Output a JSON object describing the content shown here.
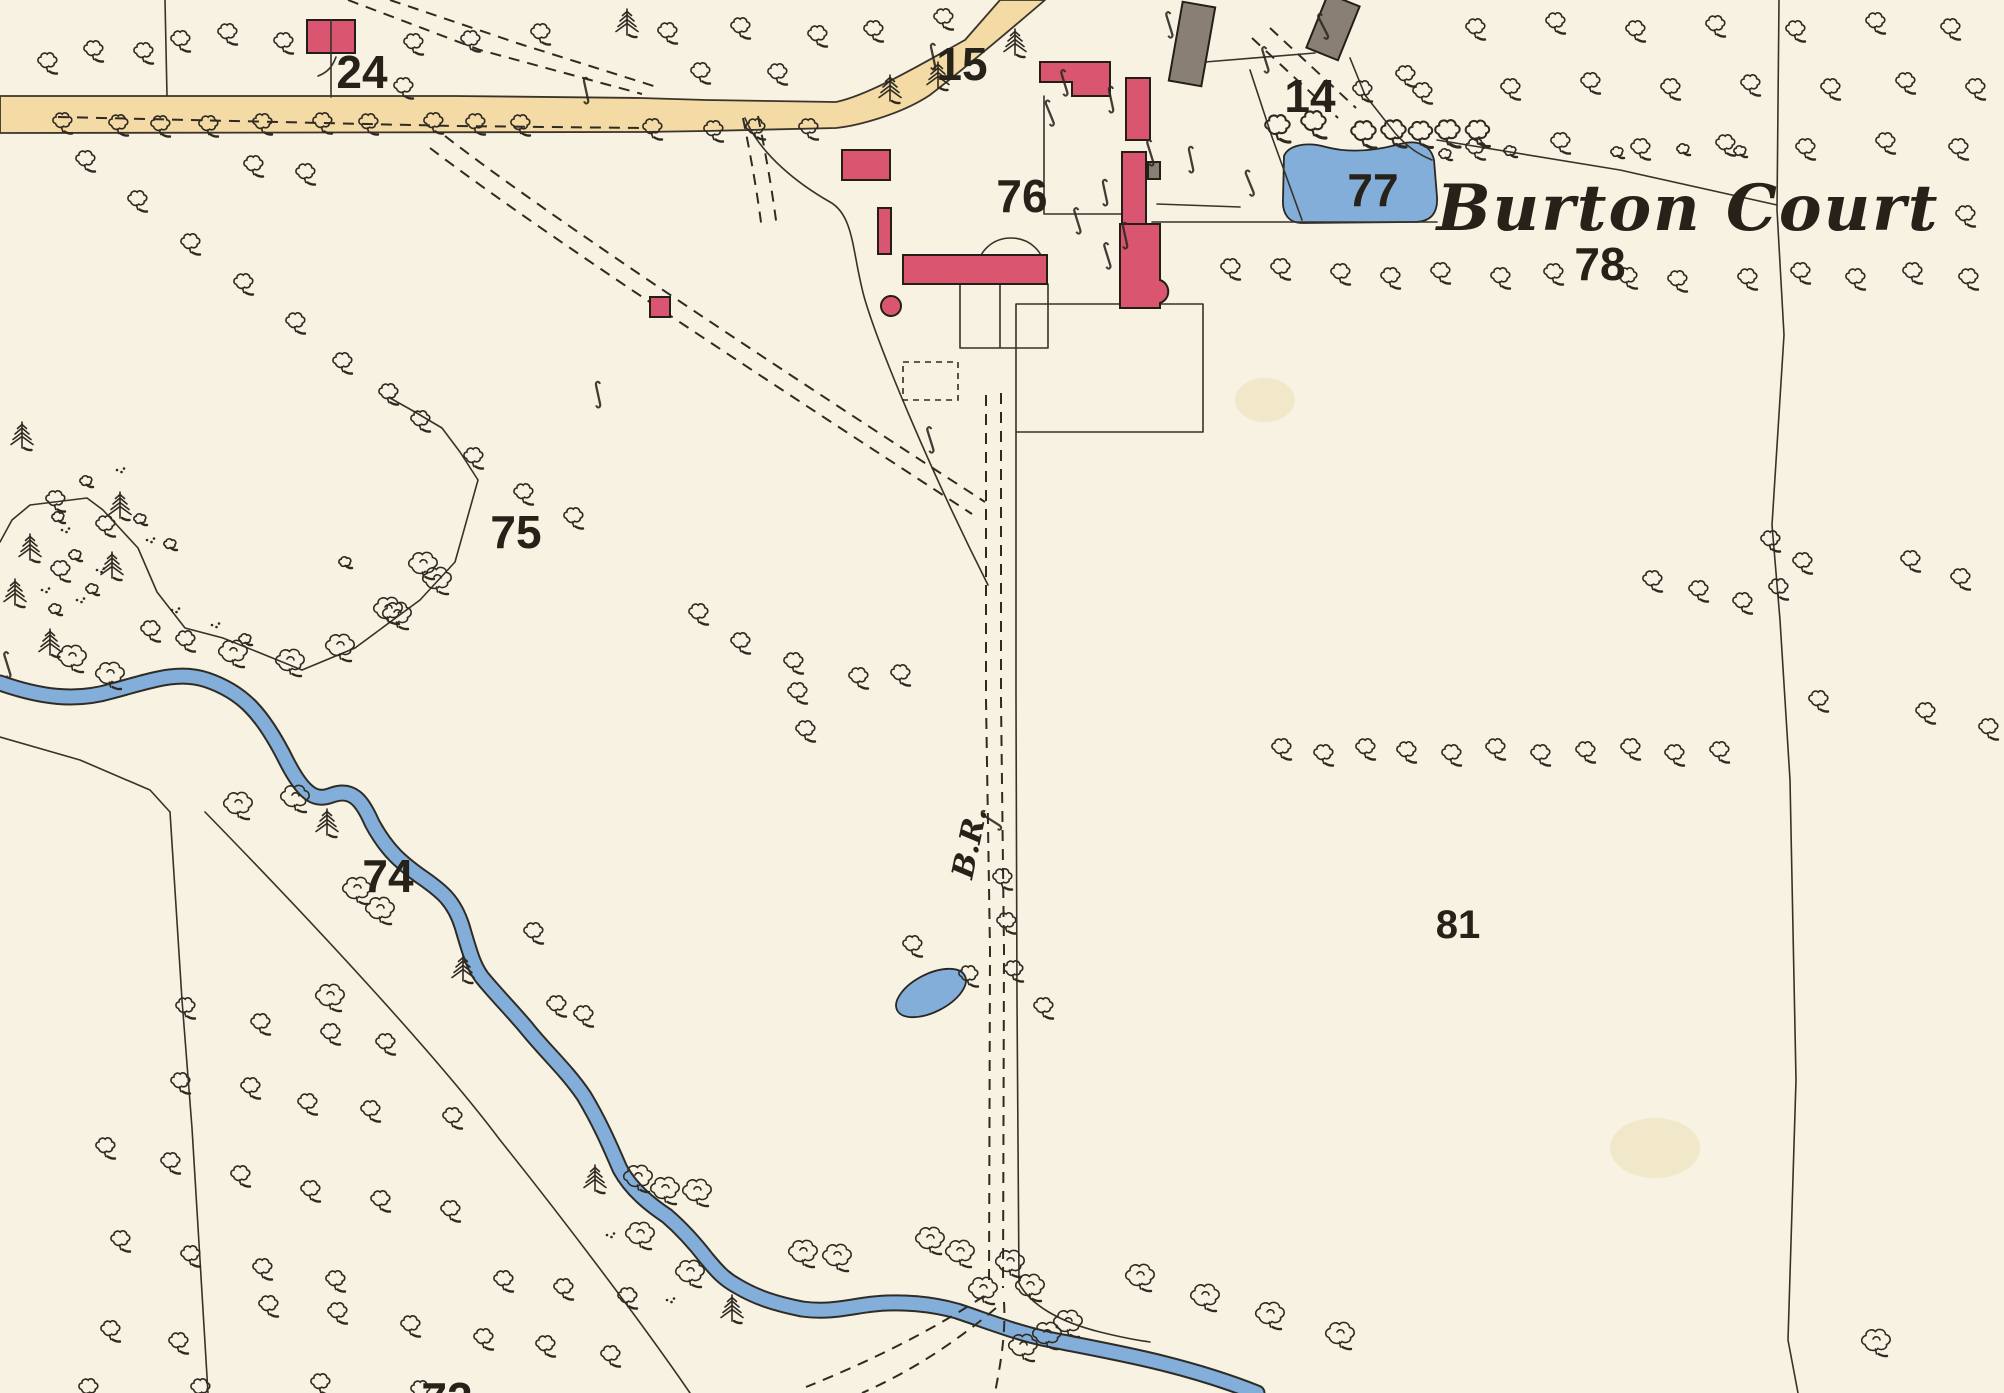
{
  "map": {
    "title": "Burton Court",
    "path_label": "B.R.",
    "parcel_numbers": {
      "p24": "24",
      "p15": "15",
      "p14": "14",
      "p76": "76",
      "p77": "77",
      "p78": "78",
      "p75": "75",
      "p74": "74",
      "p81": "81",
      "p72": "72"
    }
  },
  "icons": {
    "brace_mark": "∫"
  },
  "colors": {
    "paper": "#f7f2e1",
    "ink": "#2b2721",
    "building_red": "#da5570",
    "building_gray": "#8a7f73",
    "water_blue": "#83aed9",
    "road_tan": "#f4daa4"
  }
}
